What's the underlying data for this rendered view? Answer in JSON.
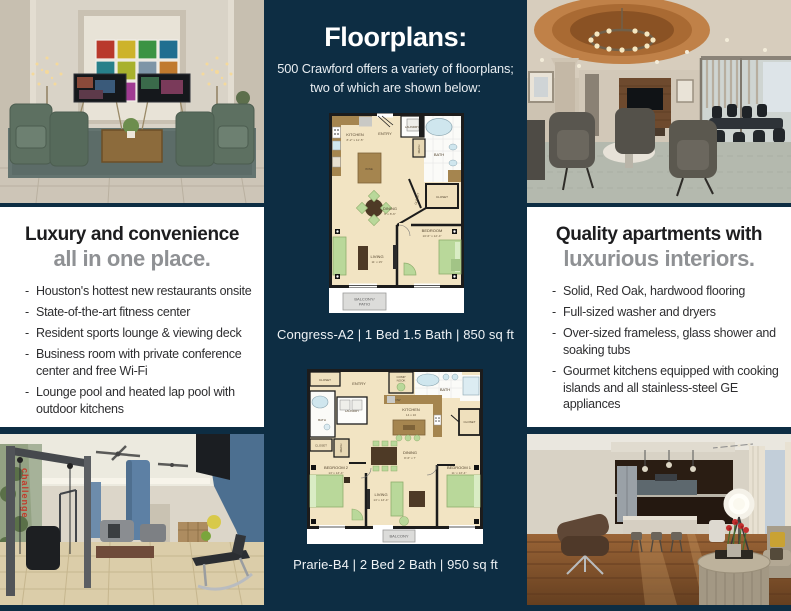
{
  "brand": {
    "navy": "#0d2d43",
    "accent_gray": "#8f9194",
    "headline_black": "#1d1d1f"
  },
  "center": {
    "title": "Floorplans:",
    "subtitle_line1": "500 Crawford offers a variety of floorplans;",
    "subtitle_line2": "two of which are shown below:",
    "floorplan1": {
      "caption": "Congress-A2 | 1 Bed 1.5 Bath | 850 sq ft",
      "rooms": {
        "kitchen": "KITCHEN",
        "kitchen_dim": "8'-2\" x 11'-5\"",
        "entry": "ENTRY",
        "laundry": "LAUNDRY",
        "mech": "MECH",
        "bath": "BATH",
        "wine": "WINE",
        "closet_hall": "CLOSET",
        "closet_bed": "CLOSET",
        "dining": "DINING",
        "dining_dim": "6' x 8'-6\"",
        "bedroom": "BEDROOM",
        "bedroom_dim": "10'-6\" x 12'-4\"",
        "living": "LIVING",
        "living_dim": "11' x 15'",
        "balcony_line1": "BALCONY/",
        "balcony_line2": "PATIO"
      }
    },
    "floorplan2": {
      "caption": "Prarie-B4 | 2 Bed 2 Bath | 950 sq ft",
      "rooms": {
        "closet_entry": "CLOSET",
        "entry": "ENTRY",
        "comp_nook_line1": "COMP",
        "comp_nook_line2": "NOOK",
        "bath_top": "BATH",
        "laundry": "LAUNDRY",
        "dw": "DW",
        "kitchen": "KITCHEN",
        "kitchen_dim": "14 x 10",
        "bath_left": "BATH",
        "closet_left": "CLOSET",
        "mech": "MECH",
        "closet_right": "CLOSET",
        "dining": "DINING",
        "dining_dim": "8'-6\" x 7'",
        "bedroom2": "BEDROOM 2",
        "bedroom2_dim": "13' x 13'-4\"",
        "living": "LIVING",
        "living_dim": "13' x 13'-4\"",
        "bedroom1": "BEDROOM 1",
        "bedroom1_dim": "11' x 13'-4\"",
        "balcony": "BALCONY"
      }
    }
  },
  "left_panel": {
    "heading": "Luxury and convenience",
    "subheading": "all in one place.",
    "bullets": [
      "Houston's hottest new restaurants onsite",
      "State-of-the-art fitness center",
      "Resident sports lounge & viewing deck",
      "Business room with private conference center and free Wi-Fi",
      "Lounge pool and heated lap pool with outdoor kitchens"
    ]
  },
  "right_panel": {
    "heading": "Quality apartments with",
    "subheading": "luxurious interiors.",
    "bullets": [
      "Solid, Red Oak, hardwood flooring",
      "Full-sized washer and dryers",
      "Over-sized frameless, glass shower and soaking tubs",
      "Gourmet kitchens equipped with cooking islands and all stainless-steel GE appliances"
    ]
  },
  "photos": {
    "gym_signage": "challenge"
  }
}
